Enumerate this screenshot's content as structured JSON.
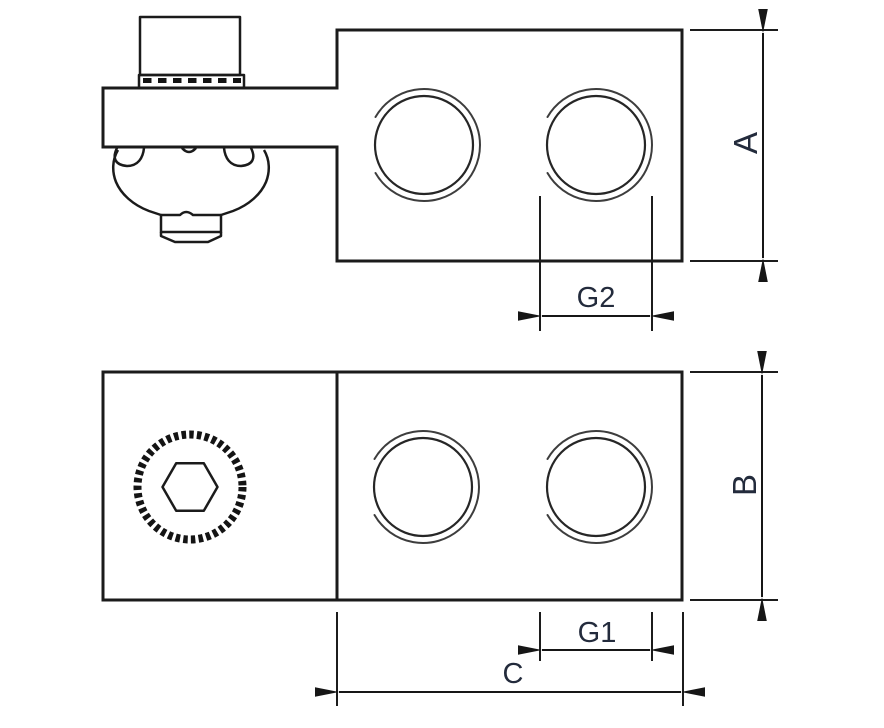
{
  "drawing": {
    "labels": {
      "dim_a": "A",
      "dim_b": "B",
      "dim_c": "C",
      "dim_g1": "G1",
      "dim_g2": "G2"
    },
    "colors": {
      "line": "#1b1b1b",
      "label_text": "#232b3c",
      "background": "#ffffff"
    }
  }
}
